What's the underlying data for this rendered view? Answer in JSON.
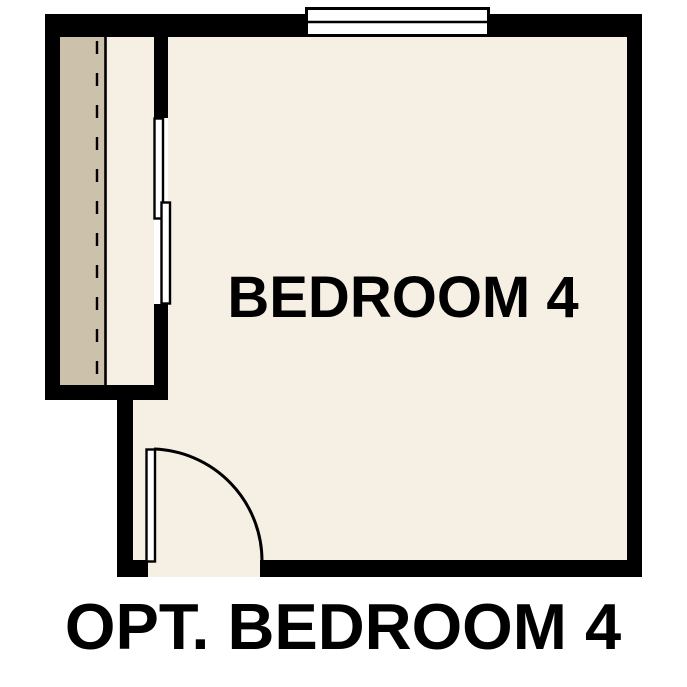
{
  "plan": {
    "room_label": "BEDROOM 4",
    "caption": "OPT. BEDROOM 4"
  },
  "colors": {
    "background": "#ffffff",
    "wall": "#000000",
    "floor": "#f6efe4",
    "closet_shelf": "#ccc1ab",
    "fixture_fill": "#ffffff",
    "line": "#000000",
    "text": "#000000"
  },
  "symbols": {
    "window": "double-line window symbol, top wall",
    "closet_bypass_doors": "two offset sliding panels on closet wall",
    "closet_rod": "dashed line along closet shelf",
    "entry_door": "90-degree door leaf with quarter-circle swing arc"
  }
}
